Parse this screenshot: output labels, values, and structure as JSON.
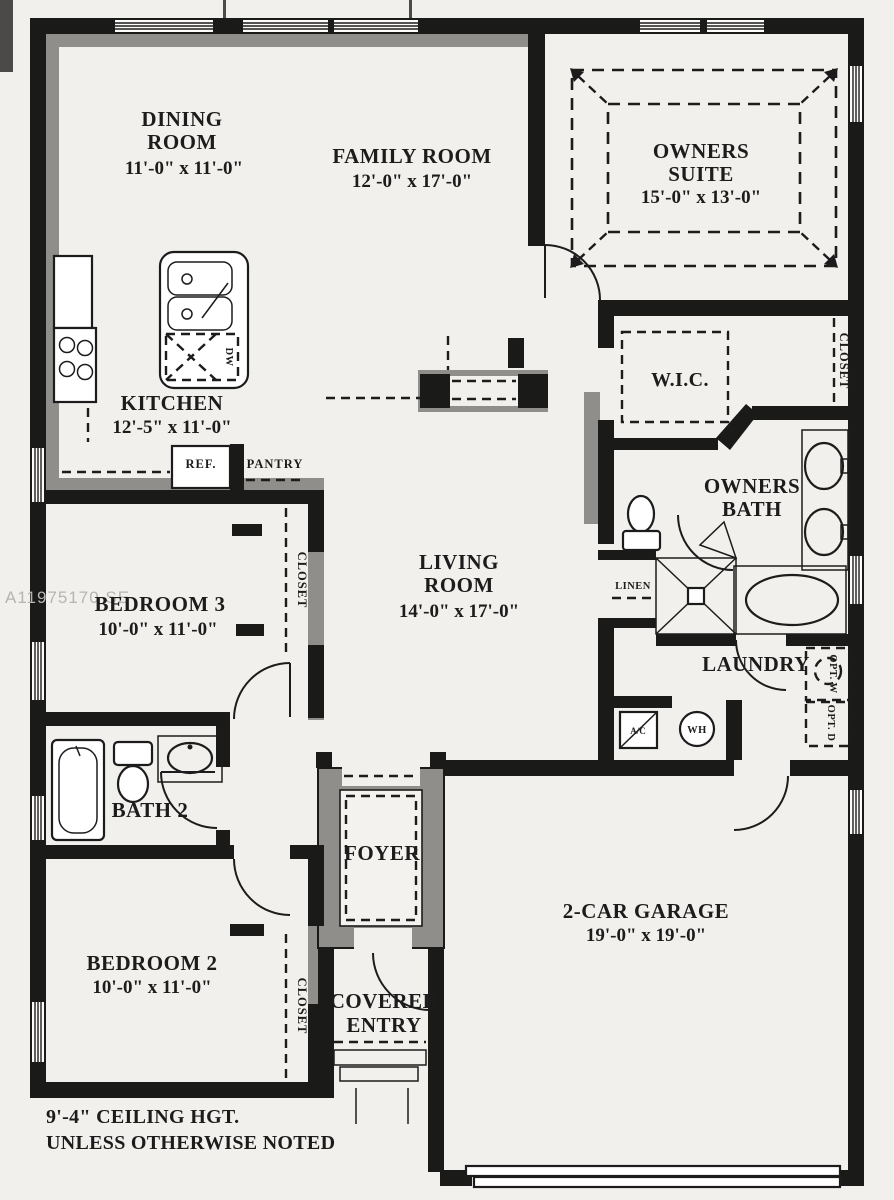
{
  "watermark": {
    "text": "A11975170 SE"
  },
  "note": {
    "l1": "9'-4\" CEILING HGT.",
    "l2": "UNLESS OTHERWISE NOTED"
  },
  "rooms": {
    "dining": {
      "l1": "DINING",
      "l2": "ROOM",
      "dims": "11'-0\" x 11'-0\""
    },
    "family": {
      "l1": "FAMILY ROOM",
      "dims": "12'-0\" x 17'-0\""
    },
    "owners_suite": {
      "l1": "OWNERS",
      "l2": "SUITE",
      "dims": "15'-0\" x 13'-0\""
    },
    "kitchen": {
      "l1": "KITCHEN",
      "dims": "12'-5\" x 11'-0\""
    },
    "wic": {
      "l1": "W.I.C."
    },
    "owners_bath": {
      "l1": "OWNERS",
      "l2": "BATH"
    },
    "living": {
      "l1": "LIVING",
      "l2": "ROOM",
      "dims": "14'-0\" x 17'-0\""
    },
    "bedroom3": {
      "l1": "BEDROOM 3",
      "dims": "10'-0\" x 11'-0\""
    },
    "laundry": {
      "l1": "LAUNDRY"
    },
    "bath2": {
      "l1": "BATH 2"
    },
    "bedroom2": {
      "l1": "BEDROOM 2",
      "dims": "10'-0\" x 11'-0\""
    },
    "foyer": {
      "l1": "FOYER"
    },
    "covered_entry": {
      "l1": "COVERED",
      "l2": "ENTRY"
    },
    "garage": {
      "l1": "2-CAR GARAGE",
      "dims": "19'-0\" x 19'-0\""
    }
  },
  "fixtures": {
    "closet": "CLOSET",
    "linen": "LINEN",
    "pantry": "PANTRY",
    "ref": "REF.",
    "ac": "A/C",
    "wh": "WH",
    "dw": "DW",
    "opt_w": "OPT. W",
    "opt_d": "OPT. D"
  },
  "colors": {
    "wall": "#1a1a19",
    "accent_wall": "#8f8e8a",
    "paper": "#f2f0ec",
    "ink": "#1c1c1c",
    "watermark": "#b7b5b1"
  }
}
